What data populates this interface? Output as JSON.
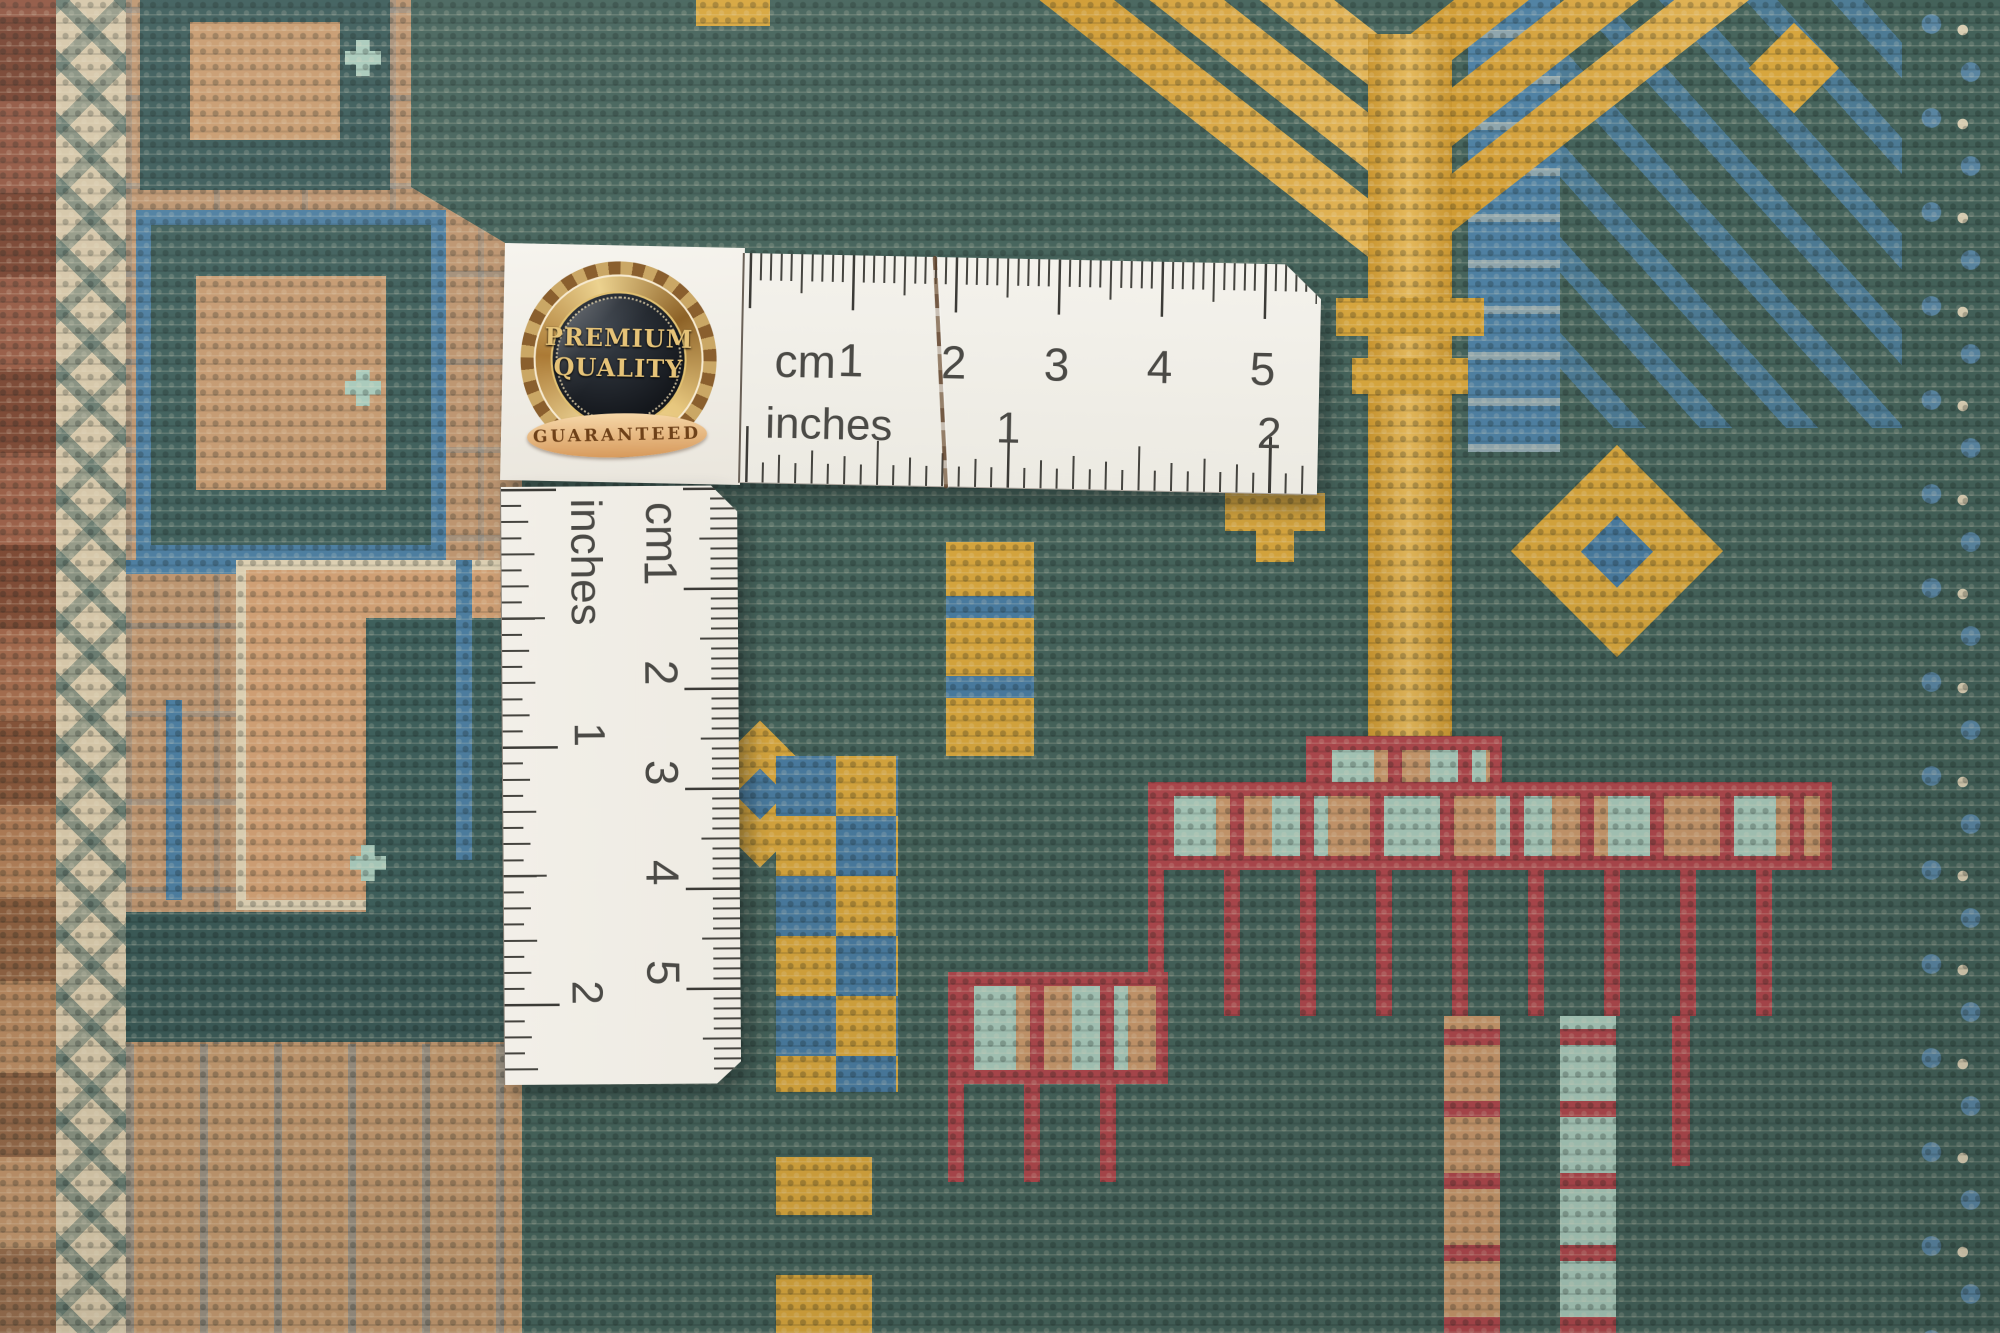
{
  "photo": {
    "badge": {
      "line1": "PREMIUM",
      "line2": "QUALITY",
      "ribbon": "GUARANTEED"
    },
    "horizontal_ruler": {
      "cm_label": "cm",
      "inches_label": "inches",
      "cm_numbers": [
        "1",
        "2",
        "3",
        "4",
        "5"
      ],
      "inch_numbers": [
        "1",
        "2"
      ]
    },
    "vertical_ruler": {
      "cm_label": "cm",
      "inches_label": "inches",
      "cm_numbers": [
        "1",
        "2",
        "3",
        "4",
        "5"
      ],
      "inch_numbers": [
        "1",
        "2"
      ]
    },
    "palette": {
      "field_teal": "#46645c",
      "steel_blue": "#4d7ea0",
      "gold": "#d7a63e",
      "red": "#b0494e",
      "mint": "#a9cabb",
      "tan": "#c0976e",
      "peach": "#cf9f74",
      "cream": "#d5c6a8",
      "rust": "#96573f",
      "ruler_white": "#f2efe9",
      "ink": "#4b4a46"
    }
  }
}
